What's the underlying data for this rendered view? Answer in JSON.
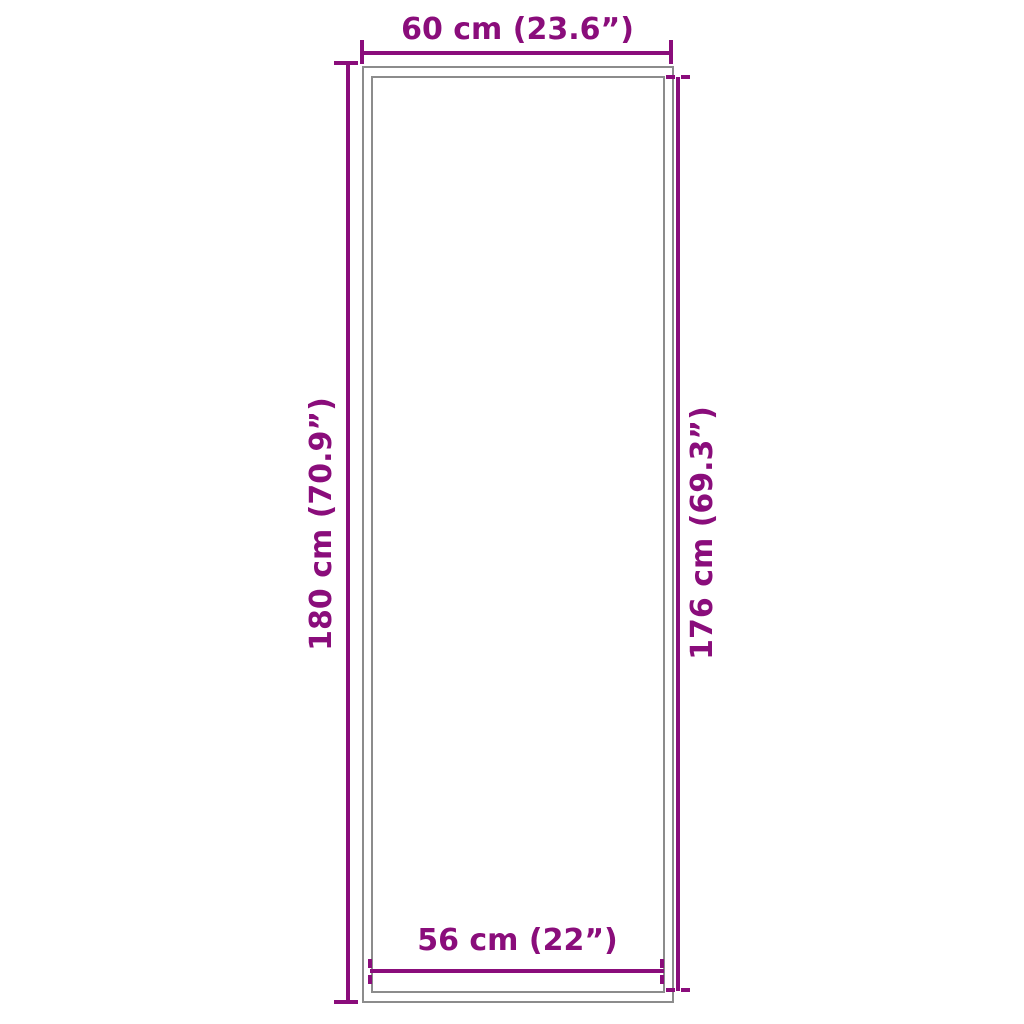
{
  "diagram": {
    "kind": "product-dimension-diagram",
    "shape": "tall-rectangle-mat-with-inner-border",
    "colors": {
      "dimension": "#8A0D7B",
      "outline": "#8C8C8C",
      "background": "#FFFFFF"
    },
    "dimensions": {
      "top": {
        "label": "60 cm (23.6”)",
        "value_cm": 60,
        "value_in": 23.6,
        "measures": "outer width",
        "tick_style": "solid"
      },
      "left": {
        "label": "180 cm (70.9”)",
        "value_cm": 180,
        "value_in": 70.9,
        "measures": "outer height",
        "tick_style": "solid"
      },
      "right": {
        "label": "176 cm (69.3”)",
        "value_cm": 176,
        "value_in": 69.3,
        "measures": "inner height",
        "tick_style": "dashed"
      },
      "bottom": {
        "label": "56 cm (22”)",
        "value_cm": 56,
        "value_in": 22,
        "measures": "inner width",
        "tick_style": "dashed"
      }
    }
  }
}
